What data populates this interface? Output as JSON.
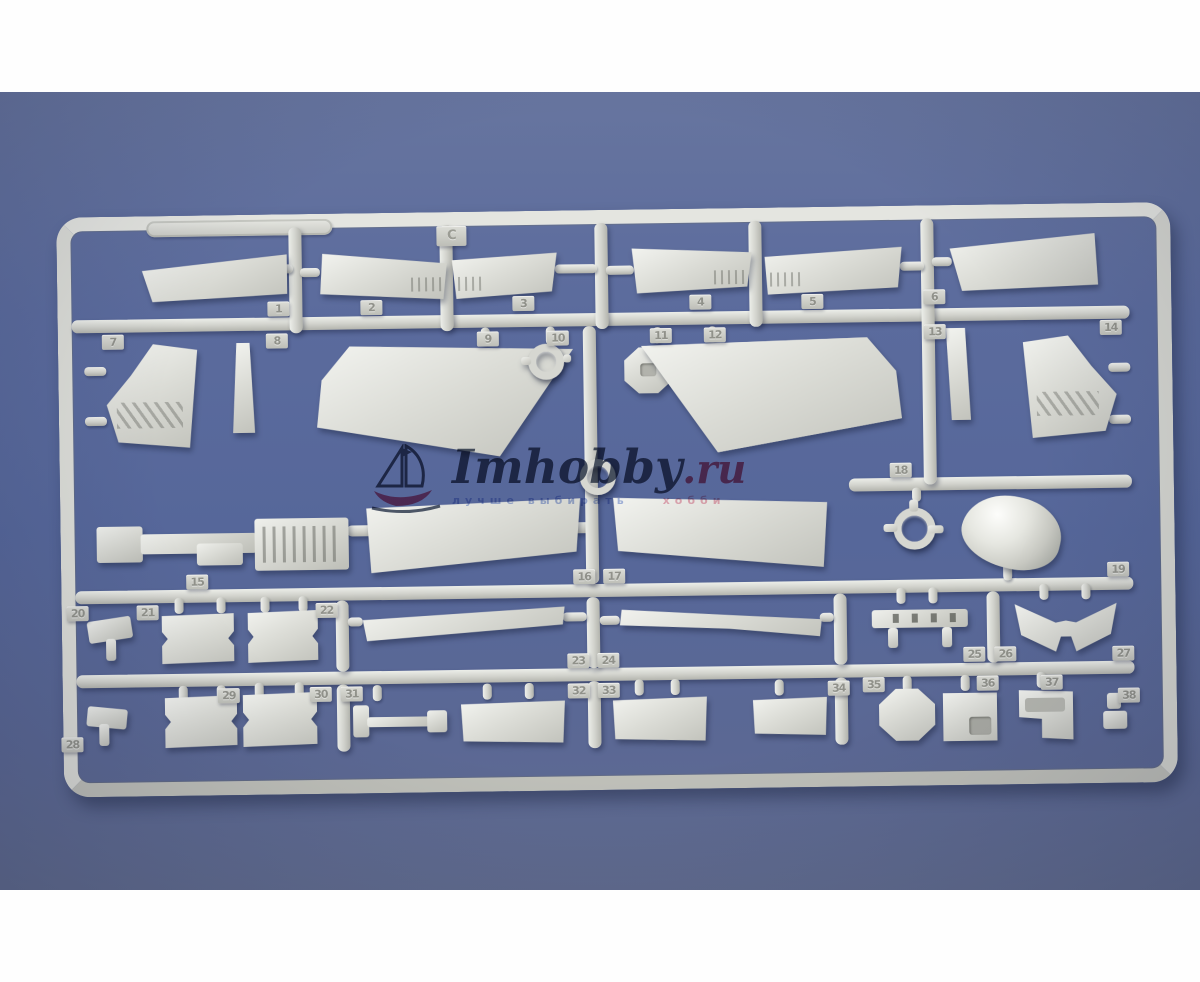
{
  "sprue": {
    "letter": "C",
    "tabs": [
      {
        "label": "1"
      },
      {
        "label": "2"
      },
      {
        "label": "3"
      },
      {
        "label": "4"
      },
      {
        "label": "5"
      },
      {
        "label": "6"
      },
      {
        "label": "7"
      },
      {
        "label": "8"
      },
      {
        "label": "9"
      },
      {
        "label": "10"
      },
      {
        "label": "11"
      },
      {
        "label": "12"
      },
      {
        "label": "13"
      },
      {
        "label": "14"
      },
      {
        "label": "15"
      },
      {
        "label": "16"
      },
      {
        "label": "17"
      },
      {
        "label": "18"
      },
      {
        "label": "19"
      },
      {
        "label": "20"
      },
      {
        "label": "21"
      },
      {
        "label": "22"
      },
      {
        "label": "23"
      },
      {
        "label": "24"
      },
      {
        "label": "25"
      },
      {
        "label": "26"
      },
      {
        "label": "27"
      },
      {
        "label": "28"
      },
      {
        "label": "29"
      },
      {
        "label": "30"
      },
      {
        "label": "31"
      },
      {
        "label": "32"
      },
      {
        "label": "33"
      },
      {
        "label": "34"
      },
      {
        "label": "35"
      },
      {
        "label": "36"
      },
      {
        "label": "37"
      },
      {
        "label": "38"
      }
    ]
  },
  "watermark": {
    "brand": "Imhobby",
    "tld": ".ru",
    "tagline_left": "лучше выбирать",
    "tagline_right": "хобби"
  },
  "colors": {
    "background_blue": "#5b6a9d",
    "plastic_gray": "#d6d7d1",
    "brand_navy": "#2d3952",
    "brand_pink": "#c63a62",
    "letterbox_white": "#fefefe"
  }
}
